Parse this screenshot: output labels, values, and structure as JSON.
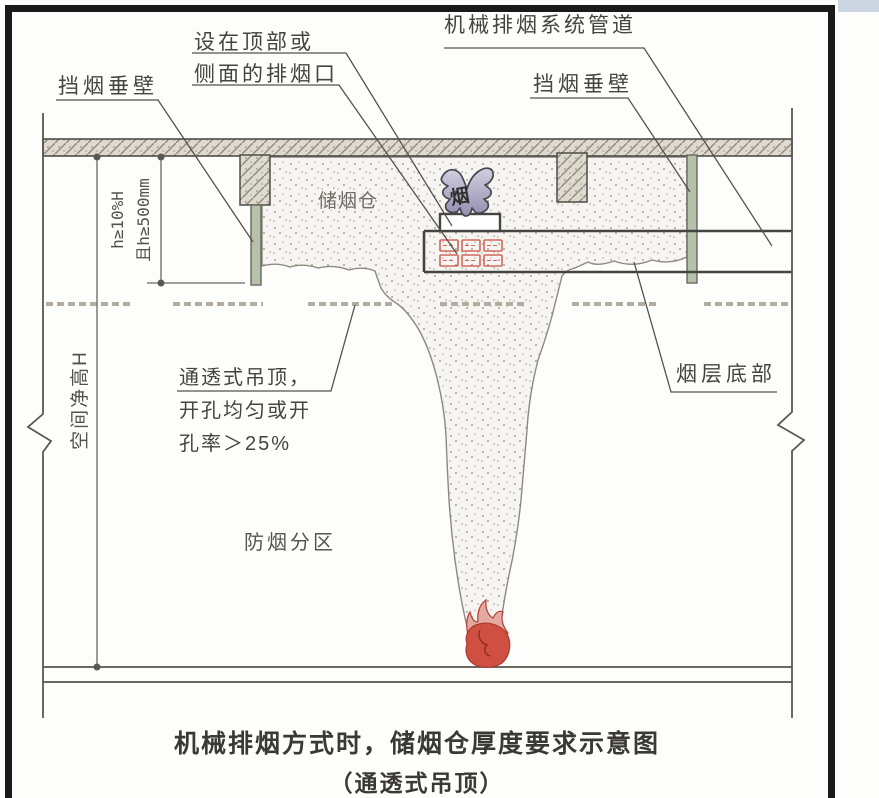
{
  "figure": {
    "labels": {
      "left_curtain": "挡烟垂壁",
      "vent_line1": "设在顶部或",
      "vent_line2": "侧面的排烟口",
      "duct": "机械排烟系统管道",
      "right_curtain": "挡烟垂壁",
      "smoke_reservoir": "储烟仓",
      "smoke_arrow_char": "烟",
      "dim_h_line1": "h≥10%H",
      "dim_h_line2": "且h≥500mm",
      "clear_height": "空间净高H",
      "permeable_line1": "通透式吊顶，",
      "permeable_line2": "开孔均匀或开",
      "permeable_line3": "孔率＞25%",
      "smoke_layer_bottom": "烟层底部",
      "smoke_zone": "防烟分区"
    },
    "caption": {
      "line1": "机械排烟方式时，储烟仓厚度要求示意图",
      "line2": "（通透式吊顶）"
    },
    "colors": {
      "curtain_fill": "#b6c1aa",
      "grille_red": "#d1685d",
      "flame_red": "#cf5042",
      "arrow_purple": "#aaa5c4",
      "structure_line": "#4f4d47",
      "dashed_ceiling": "#b2aca1"
    }
  }
}
